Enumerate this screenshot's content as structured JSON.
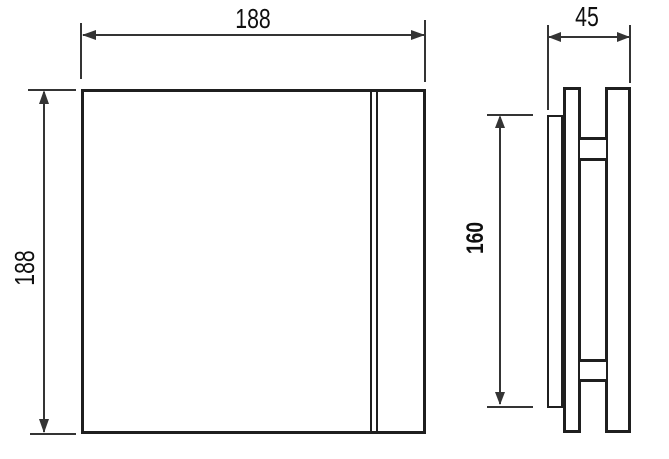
{
  "drawing": {
    "description_labels": {
      "front_width": "188",
      "front_height": "188",
      "depth": "45",
      "panel_height": "160"
    },
    "colors": {
      "part_outline": "#1f1f1f",
      "dimension_line": "#343434",
      "label_text": "#0f0f0f",
      "background": "#ffffff"
    }
  }
}
